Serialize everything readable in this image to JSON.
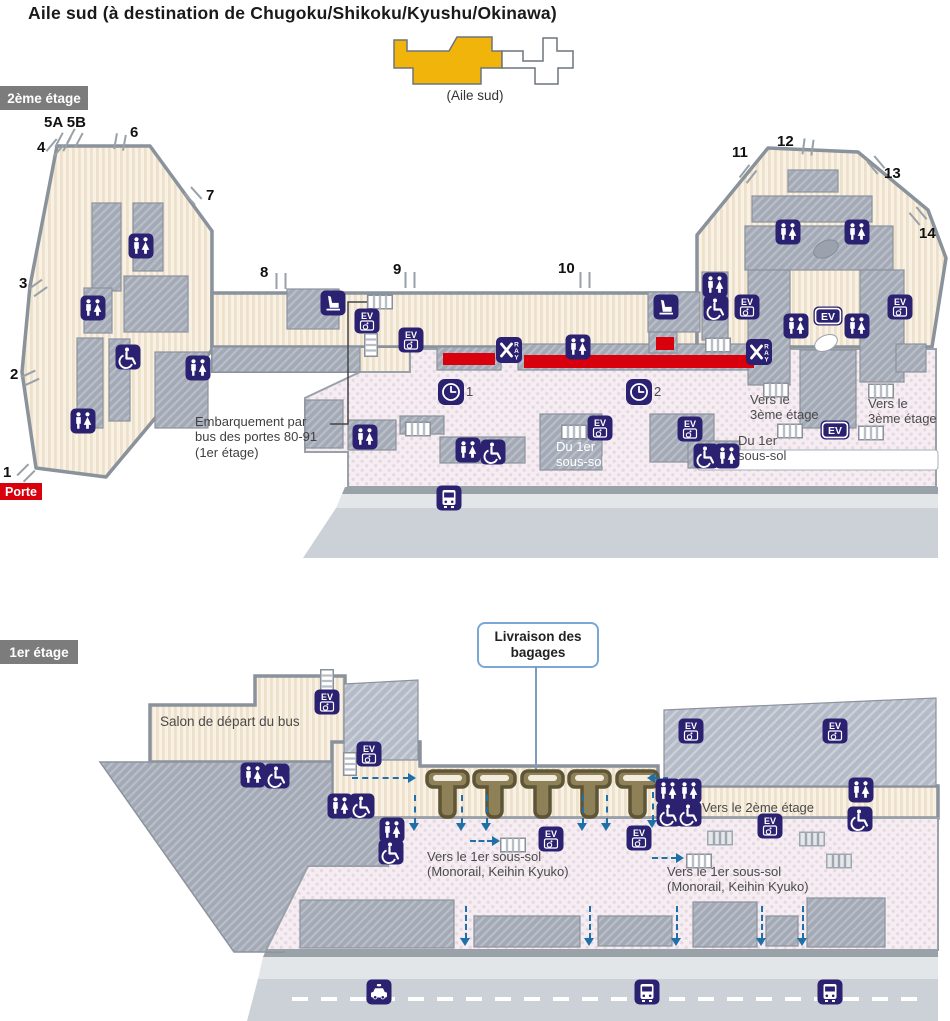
{
  "title": "Aile sud (à destination de Chugoku/Shikoku/Kyushu/Okinawa)",
  "minimap": {
    "caption": "(Aile sud)",
    "highlight_color": "#F0B40A"
  },
  "colors": {
    "icon_navy": "#2B2171",
    "alert_red": "#D8000C",
    "arrow_blue": "#1F6FA8",
    "wing_yellow": "#F0B40A"
  },
  "icon_text": {
    "elevator": "EV",
    "xray_letters": "RAY"
  },
  "floor2": {
    "badge": "2ème étage",
    "porte_label": "Porte",
    "gates": [
      {
        "label": "1",
        "x": 3,
        "y": 464
      },
      {
        "label": "2",
        "x": 10,
        "y": 366
      },
      {
        "label": "3",
        "x": 19,
        "y": 275
      },
      {
        "label": "4",
        "x": 37,
        "y": 139
      },
      {
        "label": "5A 5B",
        "x": 44,
        "y": 114
      },
      {
        "label": "6",
        "x": 130,
        "y": 124
      },
      {
        "label": "7",
        "x": 206,
        "y": 187
      },
      {
        "label": "8",
        "x": 260,
        "y": 264
      },
      {
        "label": "9",
        "x": 393,
        "y": 261
      },
      {
        "label": "10",
        "x": 558,
        "y": 260
      },
      {
        "label": "11",
        "x": 732,
        "y": 144
      },
      {
        "label": "12",
        "x": 777,
        "y": 133
      },
      {
        "label": "13",
        "x": 884,
        "y": 165
      },
      {
        "label": "14",
        "x": 919,
        "y": 225
      }
    ],
    "jetbridges": [
      {
        "x": 26,
        "y": 473,
        "r": 45
      },
      {
        "x": 30,
        "y": 378,
        "r": 65
      },
      {
        "x": 38,
        "y": 288,
        "r": 55
      },
      {
        "x": 55,
        "y": 148,
        "r": 40
      },
      {
        "x": 63,
        "y": 142,
        "r": 28
      },
      {
        "x": 75,
        "y": 138,
        "r": 28
      },
      {
        "x": 120,
        "y": 142,
        "r": 10
      },
      {
        "x": 193,
        "y": 196,
        "r": -42
      },
      {
        "x": 281,
        "y": 281,
        "r": 0
      },
      {
        "x": 410,
        "y": 280,
        "r": 0
      },
      {
        "x": 585,
        "y": 280,
        "r": 0
      },
      {
        "x": 748,
        "y": 174,
        "r": 38
      },
      {
        "x": 808,
        "y": 147,
        "r": 8
      },
      {
        "x": 876,
        "y": 165,
        "r": -40
      },
      {
        "x": 918,
        "y": 216,
        "r": -40
      }
    ],
    "labels": [
      {
        "text": "Embarquement par\nbus des portes 80-91\n(1er étage)",
        "x": 195,
        "y": 414,
        "size": 13,
        "color": "#3F3F3F"
      },
      {
        "text": "Vers le\n3ème étage",
        "x": 750,
        "y": 392,
        "size": 13,
        "color": "#4A4A4A"
      },
      {
        "text": "Vers le\n3ème étage",
        "x": 868,
        "y": 396,
        "size": 13,
        "color": "#4A4A4A"
      },
      {
        "text": "Du 1er\nsous-sol",
        "x": 556,
        "y": 439,
        "size": 13,
        "color": "#FFFFFF"
      },
      {
        "text": "Du 1er\nsous-sol",
        "x": 738,
        "y": 433,
        "size": 13,
        "color": "#4A4A4A"
      }
    ],
    "icons": [
      {
        "t": "restroom",
        "x": 141,
        "y": 246
      },
      {
        "t": "restroom",
        "x": 93,
        "y": 308
      },
      {
        "t": "restroom",
        "x": 198,
        "y": 368
      },
      {
        "t": "restroom",
        "x": 83,
        "y": 421
      },
      {
        "t": "wheelchair",
        "x": 128,
        "y": 357
      },
      {
        "t": "seat",
        "x": 333,
        "y": 303
      },
      {
        "t": "sh",
        "x": 380,
        "y": 302
      },
      {
        "t": "ev",
        "x": 367,
        "y": 321
      },
      {
        "t": "sv",
        "x": 371,
        "y": 345
      },
      {
        "t": "ev",
        "x": 411,
        "y": 340
      },
      {
        "t": "xray",
        "x": 509,
        "y": 350
      },
      {
        "t": "restroom",
        "x": 578,
        "y": 347
      },
      {
        "t": "sh",
        "x": 718,
        "y": 345
      },
      {
        "t": "xray",
        "x": 759,
        "y": 352
      },
      {
        "t": "clock",
        "x": 451,
        "y": 392,
        "label": "1"
      },
      {
        "t": "clock",
        "x": 639,
        "y": 392,
        "label": "2"
      },
      {
        "t": "seat",
        "x": 666,
        "y": 307
      },
      {
        "t": "restroom",
        "x": 715,
        "y": 285
      },
      {
        "t": "wheelchair",
        "x": 716,
        "y": 308
      },
      {
        "t": "ev",
        "x": 747,
        "y": 307
      },
      {
        "t": "ev",
        "x": 900,
        "y": 307
      },
      {
        "t": "restroom",
        "x": 788,
        "y": 232
      },
      {
        "t": "restroom",
        "x": 857,
        "y": 232
      },
      {
        "t": "evp",
        "x": 828,
        "y": 316
      },
      {
        "t": "restroom",
        "x": 796,
        "y": 326
      },
      {
        "t": "restroom",
        "x": 857,
        "y": 326
      },
      {
        "t": "restroom",
        "x": 365,
        "y": 437
      },
      {
        "t": "sh",
        "x": 418,
        "y": 429
      },
      {
        "t": "restroom",
        "x": 468,
        "y": 450
      },
      {
        "t": "wheelchair",
        "x": 493,
        "y": 452
      },
      {
        "t": "sh",
        "x": 574,
        "y": 432
      },
      {
        "t": "ev",
        "x": 600,
        "y": 428
      },
      {
        "t": "ev",
        "x": 690,
        "y": 429
      },
      {
        "t": "wheelchair",
        "x": 706,
        "y": 456
      },
      {
        "t": "restroom",
        "x": 727,
        "y": 456
      },
      {
        "t": "sh",
        "x": 776,
        "y": 390
      },
      {
        "t": "sh",
        "x": 881,
        "y": 391
      },
      {
        "t": "sh",
        "x": 790,
        "y": 431
      },
      {
        "t": "evp",
        "x": 835,
        "y": 430
      },
      {
        "t": "sh",
        "x": 871,
        "y": 433
      },
      {
        "t": "bus",
        "x": 449,
        "y": 498
      }
    ]
  },
  "floor1": {
    "badge": "1er étage",
    "callout": {
      "text": "Livraison des\nbagages"
    },
    "labels": [
      {
        "text": "Salon de départ du bus",
        "x": 160,
        "y": 714,
        "size": 13.5,
        "color": "#4A4A4A"
      },
      {
        "text": "Vers le 2ème étage",
        "x": 702,
        "y": 800,
        "size": 13,
        "color": "#4A4A4A"
      },
      {
        "text": "Vers le 1er sous-sol\n(Monorail, Keihin Kyuko)",
        "x": 427,
        "y": 849,
        "size": 13,
        "color": "#4A4A4A"
      },
      {
        "text": "Vers le 1er sous-sol\n(Monorail, Keihin Kyuko)",
        "x": 667,
        "y": 864,
        "size": 13,
        "color": "#4A4A4A"
      }
    ],
    "icons": [
      {
        "t": "sv",
        "x": 327,
        "y": 681
      },
      {
        "t": "ev",
        "x": 327,
        "y": 702
      },
      {
        "t": "restroom",
        "x": 253,
        "y": 775
      },
      {
        "t": "wheelchair",
        "x": 277,
        "y": 776
      },
      {
        "t": "sv",
        "x": 350,
        "y": 764
      },
      {
        "t": "ev",
        "x": 369,
        "y": 754
      },
      {
        "t": "restroom",
        "x": 340,
        "y": 806
      },
      {
        "t": "wheelchair",
        "x": 362,
        "y": 806
      },
      {
        "t": "restroom",
        "x": 392,
        "y": 830
      },
      {
        "t": "wheelchair",
        "x": 391,
        "y": 852
      },
      {
        "t": "sh",
        "x": 513,
        "y": 845
      },
      {
        "t": "ev",
        "x": 551,
        "y": 839
      },
      {
        "t": "ev",
        "x": 639,
        "y": 838
      },
      {
        "t": "ev",
        "x": 691,
        "y": 731
      },
      {
        "t": "ev",
        "x": 835,
        "y": 731
      },
      {
        "t": "restroom",
        "x": 668,
        "y": 791
      },
      {
        "t": "restroom",
        "x": 689,
        "y": 791
      },
      {
        "t": "restroom",
        "x": 861,
        "y": 790
      },
      {
        "t": "wheelchair",
        "x": 669,
        "y": 814
      },
      {
        "t": "wheelchair",
        "x": 689,
        "y": 814
      },
      {
        "t": "wheelchair",
        "x": 860,
        "y": 819
      },
      {
        "t": "ev",
        "x": 770,
        "y": 826
      },
      {
        "t": "shg",
        "x": 720,
        "y": 838
      },
      {
        "t": "shg",
        "x": 812,
        "y": 839
      },
      {
        "t": "sh",
        "x": 699,
        "y": 861
      },
      {
        "t": "shg",
        "x": 839,
        "y": 861
      },
      {
        "t": "taxi",
        "x": 379,
        "y": 992
      },
      {
        "t": "bus",
        "x": 647,
        "y": 992
      },
      {
        "t": "bus",
        "x": 830,
        "y": 992
      }
    ],
    "arrows": [
      {
        "d": "right",
        "x": 352,
        "y": 778,
        "l": 64
      },
      {
        "d": "left",
        "x": 648,
        "y": 778,
        "l": 20
      },
      {
        "d": "down",
        "x": 653,
        "y": 792,
        "l": 36
      },
      {
        "d": "down",
        "x": 415,
        "y": 795,
        "l": 36
      },
      {
        "d": "down",
        "x": 462,
        "y": 795,
        "l": 36
      },
      {
        "d": "down",
        "x": 487,
        "y": 795,
        "l": 36
      },
      {
        "d": "down",
        "x": 583,
        "y": 795,
        "l": 36
      },
      {
        "d": "down",
        "x": 607,
        "y": 795,
        "l": 36
      },
      {
        "d": "right",
        "x": 470,
        "y": 841,
        "l": 30
      },
      {
        "d": "right",
        "x": 652,
        "y": 858,
        "l": 32
      },
      {
        "d": "down",
        "x": 466,
        "y": 906,
        "l": 40
      },
      {
        "d": "down",
        "x": 590,
        "y": 906,
        "l": 40
      },
      {
        "d": "down",
        "x": 677,
        "y": 906,
        "l": 40
      },
      {
        "d": "down",
        "x": 762,
        "y": 906,
        "l": 40
      },
      {
        "d": "down",
        "x": 803,
        "y": 906,
        "l": 40
      }
    ],
    "carousels": [
      {
        "x": 425
      },
      {
        "x": 472
      },
      {
        "x": 520
      },
      {
        "x": 567
      },
      {
        "x": 615
      }
    ]
  }
}
